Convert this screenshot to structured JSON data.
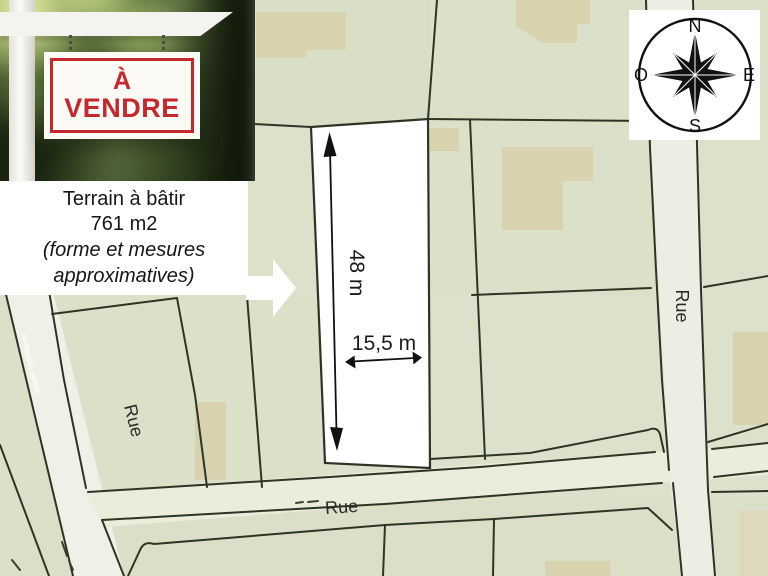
{
  "photo_sign": {
    "line1": "À",
    "line2": "VENDRE"
  },
  "info_box": {
    "lines": [
      "Terrain à bâtir",
      "761 m2",
      "(forme et mesures",
      "approximatives)"
    ]
  },
  "parcel": {
    "height_label": "48 m",
    "width_label": "15,5 m"
  },
  "streets": {
    "left": "Rue",
    "bottom": "Rue",
    "right": "Rue"
  },
  "compass": {
    "north": "N",
    "east": "E",
    "south": "S",
    "west": "O"
  },
  "colors": {
    "map_background": "#dce1cb",
    "street_fill": "#f0efe7",
    "building_fill": "#d8d3ae",
    "boundary_line": "#2d3425",
    "parcel_fill": "#ffffff",
    "sign_red": "#c5272e"
  }
}
